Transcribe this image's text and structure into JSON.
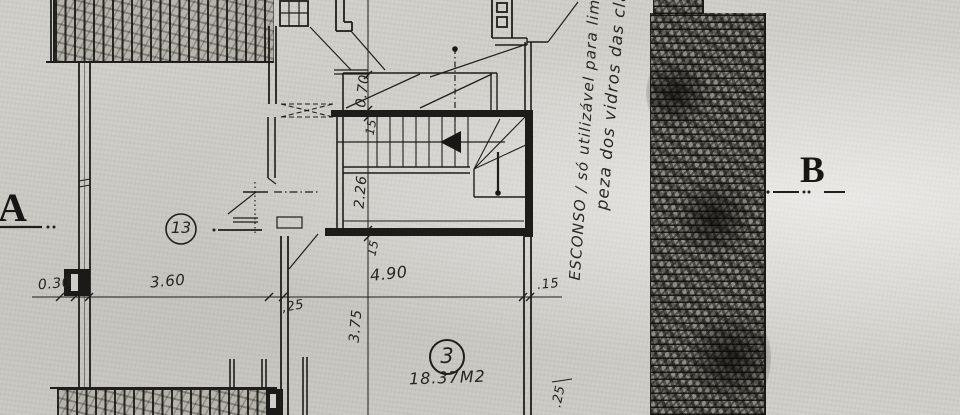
{
  "plan": {
    "section_markers": {
      "a": "A",
      "b": "B"
    },
    "rooms": [
      {
        "id": "room-13",
        "number": "13"
      },
      {
        "id": "room-3",
        "number": "3",
        "area": "18.37M2"
      }
    ],
    "note": {
      "line1": "ESCONSO / só utilizável para lim",
      "line2": "peza dos vidros das cla"
    },
    "dimensions": {
      "h030": "0.30",
      "h360": "3.60",
      "h25": ",25",
      "h490": "4.90",
      "h15": ".15",
      "v070": "0.70",
      "v15a": "15",
      "v226": "2.26",
      "v15b": "15",
      "v375": "3.75",
      "v25": ".25"
    },
    "colors": {
      "paper": "#d3d1cc",
      "ink": "#1f1e1c"
    }
  }
}
